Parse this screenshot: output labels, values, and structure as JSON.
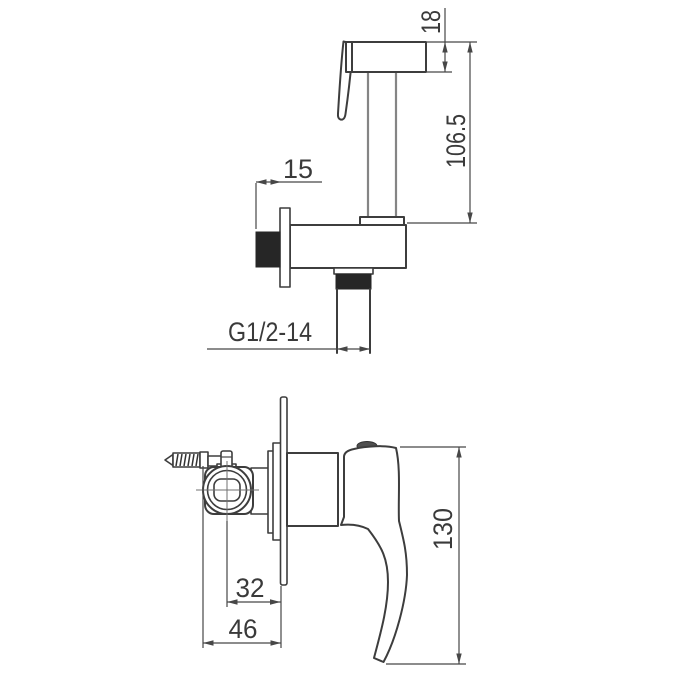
{
  "page": {
    "background": "#ffffff",
    "description": "Technical dimension drawing, two orthographic side views of a bidet sprayer with wall bracket (top) and concealed mixer valve with lever handle (bottom)"
  },
  "colors": {
    "outline": "#3d3d3d",
    "dimension_lines": "#474747",
    "dimension_text": "#3a3a3a",
    "thread_black_fill": "#262626",
    "stem_gray": "#858585",
    "centerline": "#707070",
    "handle_button": "#4f4f4f"
  },
  "dims": {
    "d18": "18",
    "d106": "106.5",
    "d15": "15",
    "thread": "G1/2-14",
    "d32": "32",
    "d46": "46",
    "d130": "130"
  }
}
